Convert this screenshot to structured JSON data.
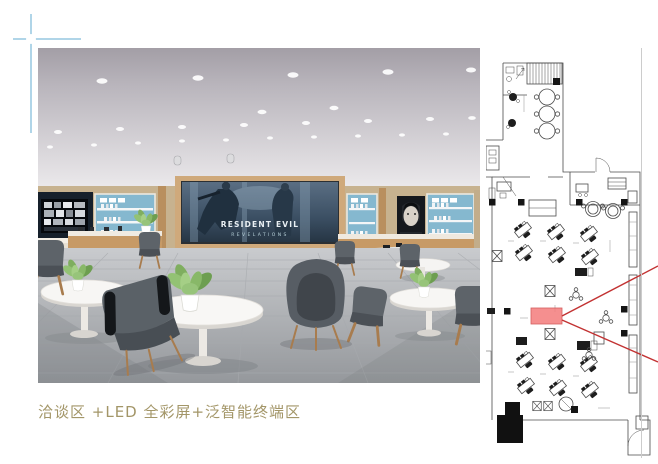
{
  "caption": {
    "text": "洽谈区 +LED 全彩屏+泛智能终端区"
  },
  "interior_render": {
    "led_screen": {
      "title_line1": "RESIDENT EVIL",
      "title_line2": "REVELATIONS"
    }
  },
  "floor_plan": {
    "symbols": [
      "staircase-hatch",
      "round-tables",
      "workstation-desks",
      "columns",
      "led-screen-highlight",
      "view-cone",
      "entrance-door",
      "display-counters"
    ]
  },
  "colors": {
    "accent_blue": "#b0d5e8",
    "caption_text": "#a39668",
    "shelf_blue": "#85b8cf",
    "wood": "#c79a66",
    "wall_beige": "#c7b28f",
    "chair_gray": "#575d64",
    "plant_green": "#84b162",
    "plan_line": "#4b4b4b",
    "plan_highlight": "#f47c7c",
    "plan_red": "#c23232",
    "divider_gray": "#cccccc"
  }
}
